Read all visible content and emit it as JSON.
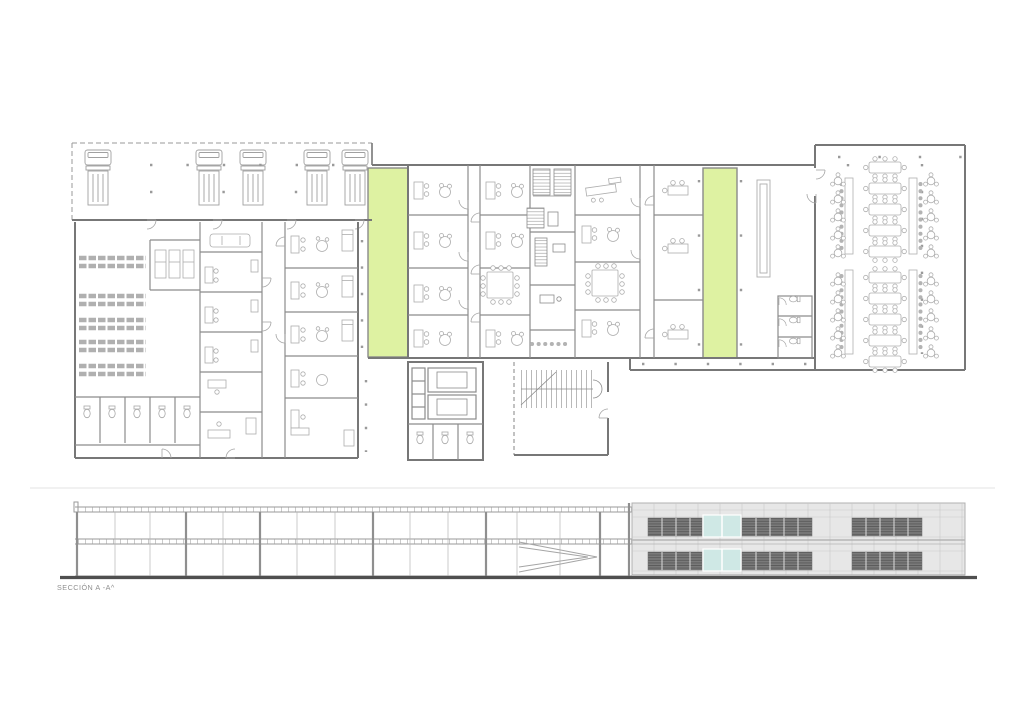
{
  "document": {
    "section_label": "SECCIÓN A -A^"
  },
  "colors": {
    "background": "#ffffff",
    "wall_gray": "#777777",
    "partition_gray": "#8c8c8c",
    "furniture_gray": "#a9a9a9",
    "highlight_green": "#def2a2",
    "facade_panel": "#e7e7e7",
    "facade_joint": "#c9c9c9",
    "louver_dark": "#7a7a7a",
    "glazing_cyan": "#cfe8e5",
    "ground_dark": "#4f4f4f",
    "divider_light": "#e3e3e3"
  },
  "plan": {
    "loading_dock": {
      "truck_count": 5
    },
    "green_corridor_count": 2,
    "canteen": {
      "long_tables": 10,
      "round_tables": 20,
      "counters": 4
    },
    "office_block": {
      "meeting_rooms": 2
    },
    "cores": {
      "elevator_shafts": 2,
      "stair_cores": 2
    }
  },
  "section": {
    "label": "SECCIÓN A -A^",
    "floors": 2,
    "glazed_panels": 4
  }
}
